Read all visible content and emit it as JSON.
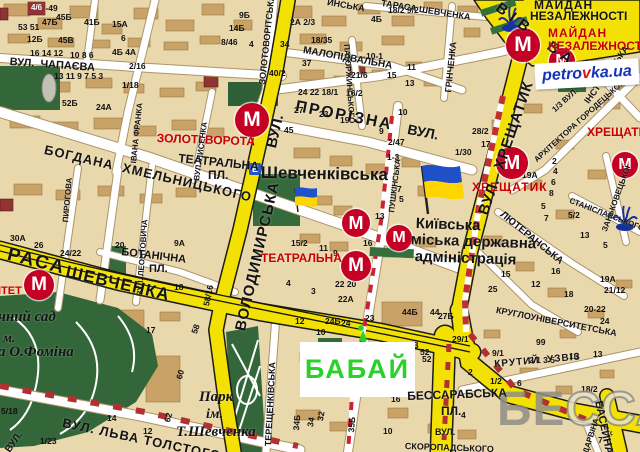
{
  "map": {
    "name": "kyiv-city-map"
  },
  "marker": {
    "label": "БАБАЙ",
    "color": "#2bd12b"
  },
  "watermark": {
    "part1": "БЕ",
    "part2": "ССА"
  },
  "logo": {
    "part1": "petro",
    "part2": "v",
    "part3": "ka.ua"
  },
  "signs": {
    "e": "Е"
  },
  "metro": {
    "symbol": "М",
    "color": "#c40024",
    "stations": [
      {
        "x": 252,
        "y": 120,
        "r": 17
      },
      {
        "x": 356,
        "y": 223,
        "r": 14
      },
      {
        "x": 399,
        "y": 238,
        "r": 13
      },
      {
        "x": 356,
        "y": 266,
        "r": 15
      },
      {
        "x": 39,
        "y": 285,
        "r": 15
      },
      {
        "x": 512,
        "y": 163,
        "r": 16
      },
      {
        "x": 625,
        "y": 165,
        "r": 13
      },
      {
        "x": 523,
        "y": 45,
        "r": 17
      },
      {
        "x": 562,
        "y": 61,
        "r": 13
      }
    ]
  },
  "badges": [
    {
      "t": "4/6",
      "x": 28,
      "y": 2
    }
  ],
  "labels": [
    {
      "n": "street-chapaieva",
      "t": "ВУЛ.  ЧАПАЄВА",
      "x": 10,
      "y": 57,
      "fs": 11,
      "rot": 4
    },
    {
      "n": "street-yaroslaviv-val",
      "t": "ВІВ  ВАЛ",
      "x": 502,
      "y": 0,
      "fs": 15,
      "rot": 37,
      "ls": 6
    },
    {
      "n": "street-irynynska-frag",
      "t": "ИНСЬКА",
      "x": 328,
      "y": -2,
      "fs": 9,
      "rot": 10
    },
    {
      "n": "street-prov-tarasa-shevchenka",
      "t": "ТАРАСА ШЕВЧЕНКА",
      "x": 382,
      "y": -1,
      "fs": 9,
      "rot": 9
    },
    {
      "n": "street-zolotovoritska",
      "t": "ЗОЛОТОВОРІТСЬКА",
      "x": 258,
      "y": 84,
      "fs": 9,
      "rot": -84
    },
    {
      "n": "street-malopidvalna",
      "t": "МАЛОПІДВАЛЬНА",
      "x": 304,
      "y": 46,
      "fs": 10,
      "rot": 10
    },
    {
      "n": "street-patorzhynskoho",
      "t": "ПАТОРЖИНСЬКОГО",
      "x": 350,
      "y": 44,
      "fs": 8,
      "rot": 86
    },
    {
      "n": "street-hrinchenka",
      "t": "ГРІНЧЕНКА",
      "x": 444,
      "y": 92,
      "fs": 9,
      "rot": -84
    },
    {
      "n": "label-maidan-line1",
      "t": "МАЙДАН",
      "x": 534,
      "y": -1,
      "fs": 12,
      "ls": 1
    },
    {
      "n": "label-maidan-line2",
      "t": "НЕЗАЛЕЖНОСТІ",
      "x": 530,
      "y": 10,
      "fs": 12
    },
    {
      "n": "metro-label-maidan-line1",
      "t": "МАЙДАН",
      "x": 548,
      "y": 27,
      "fs": 12,
      "c": "#c80000",
      "ls": 1
    },
    {
      "n": "metro-label-maidan-line2",
      "t": "НЕЗАЛЕЖНОСТІ",
      "x": 548,
      "y": 40,
      "fs": 12,
      "c": "#c80000"
    },
    {
      "n": "street-instytutska",
      "t": "ІНСТИТУТСЬКА",
      "x": 583,
      "y": 100,
      "fs": 9,
      "rot": -54
    },
    {
      "n": "street-horodetskoho-num",
      "t": "1/3 ВУЛ.",
      "x": 551,
      "y": 108,
      "fs": 8,
      "rot": -42
    },
    {
      "n": "street-horodetskoho",
      "t": "АРХІТЕКТОРА ГОРОДЕЦЬКОГО",
      "x": 533,
      "y": 158,
      "fs": 8,
      "rot": -42
    },
    {
      "n": "street-prorizna",
      "t": "ПРОРІЗНА",
      "x": 297,
      "y": 99,
      "fs": 16,
      "rot": 11,
      "ls": 2
    },
    {
      "n": "street-prorizna-vul",
      "t": "ВУЛ.",
      "x": 409,
      "y": 122,
      "fs": 14,
      "rot": 11
    },
    {
      "n": "metro-label-zoloti-vorota",
      "t": "ЗОЛОТІ ВОРОТА",
      "x": 157,
      "y": 132,
      "fs": 12,
      "c": "#c80000",
      "rot": 2
    },
    {
      "n": "label-teatralna-pl-line1",
      "t": "ТЕАТРАЛЬНА",
      "x": 179,
      "y": 152,
      "fs": 12,
      "rot": 6
    },
    {
      "n": "label-teatralna-pl-line2",
      "t": "ПЛ.",
      "x": 208,
      "y": 169,
      "fs": 12
    },
    {
      "n": "street-volodymyrska",
      "t": "ВОЛОДИМИРСЬКА",
      "x": 233,
      "y": 329,
      "fs": 15,
      "rot": -77,
      "ls": 1
    },
    {
      "n": "street-volodymyrska-vul",
      "t": "ВУЛ.",
      "x": 264,
      "y": 146,
      "fs": 15,
      "rot": -77
    },
    {
      "n": "label-shevchenkivska",
      "t": "Шевченківська",
      "x": 261,
      "y": 164,
      "fs": 17,
      "rot": 1
    },
    {
      "n": "street-lysenka",
      "t": "ВУЛ. ЛИСЕНКА",
      "x": 193,
      "y": 180,
      "fs": 8,
      "rot": -82
    },
    {
      "n": "street-ivana-franka",
      "t": "ІВАНА ФРАНКА",
      "x": 130,
      "y": 163,
      "fs": 8,
      "rot": -84
    },
    {
      "n": "street-khmelnytskoho",
      "t": "БОГДАНА  ХМЕЛЬНИЦЬКОГО",
      "x": 46,
      "y": 143,
      "fs": 13,
      "rot": 13,
      "ls": 1
    },
    {
      "n": "street-pyrohova",
      "t": "ПИРОГОВА",
      "x": 62,
      "y": 222,
      "fs": 8,
      "rot": -85
    },
    {
      "n": "street-leontovycha",
      "t": "ВУЛ. ЛЕОНТОВИЧА",
      "x": 136,
      "y": 296,
      "fs": 8,
      "rot": -86
    },
    {
      "n": "metro-label-teatralna",
      "t": "ТЕАТРАЛЬНА",
      "x": 261,
      "y": 252,
      "fs": 12,
      "c": "#c80000"
    },
    {
      "n": "label-kmda-line1",
      "t": "Київська",
      "x": 416,
      "y": 216,
      "fs": 15,
      "rot": 2
    },
    {
      "n": "label-kmda-line2",
      "t": "міська державна",
      "x": 411,
      "y": 232,
      "fs": 15,
      "rot": 2
    },
    {
      "n": "label-kmda-line3",
      "t": "адміністрація",
      "x": 415,
      "y": 249,
      "fs": 15,
      "rot": 2
    },
    {
      "n": "metro-label-khreshchatyk-1",
      "t": "ХРЕЩАТИК",
      "x": 472,
      "y": 181,
      "fs": 12,
      "c": "#c80000",
      "ls": 1
    },
    {
      "n": "metro-label-khreshchatyk-2",
      "t": "ХРЕЩАТИК",
      "x": 587,
      "y": 126,
      "fs": 12,
      "c": "#c80000"
    },
    {
      "n": "street-khreshchatyk",
      "t": "ВУЛ.  ХРЕЩАТИК",
      "x": 476,
      "y": 212,
      "fs": 15,
      "rot": -71,
      "ls": 1
    },
    {
      "n": "street-liuteranska",
      "t": "ЛЮТЕРАНСЬКА",
      "x": 504,
      "y": 210,
      "fs": 10,
      "rot": 39
    },
    {
      "n": "street-zankovetskoi",
      "t": "ЗАНЬКОВЕЦЬКОЇ",
      "x": 601,
      "y": 230,
      "fs": 8,
      "rot": -70
    },
    {
      "n": "street-stanislavskoho",
      "t": "СТАНІСЛАВСЬКОГО",
      "x": 571,
      "y": 197,
      "fs": 8,
      "rot": 21
    },
    {
      "n": "label-botanichna-line1",
      "t": "БОТАНІЧНА",
      "x": 122,
      "y": 247,
      "fs": 11,
      "rot": 7
    },
    {
      "n": "label-botanichna-line2",
      "t": "ПЛ.",
      "x": 149,
      "y": 264,
      "fs": 11
    },
    {
      "n": "street-taras-blvd-1",
      "t": "РАСА",
      "x": 10,
      "y": 245,
      "fs": 19,
      "rot": 14,
      "ls": 2
    },
    {
      "n": "street-taras-blvd-2",
      "t": "ШЕВЧЕНКА",
      "x": 68,
      "y": 263,
      "fs": 17,
      "rot": 13,
      "ls": 1
    },
    {
      "n": "metro-label-universytet-frag",
      "t": "ІТЕТ",
      "x": -2,
      "y": 286,
      "fs": 11,
      "c": "#c80000"
    },
    {
      "n": "label-botsad-line1",
      "t": "чний сад",
      "x": -2,
      "y": 310,
      "fs": 15,
      "f": 1
    },
    {
      "n": "label-botsad-line2",
      "t": "м.",
      "x": 3,
      "y": 331,
      "fs": 13,
      "f": 1
    },
    {
      "n": "label-botsad-line3",
      "t": "а О.Фоміна",
      "x": -2,
      "y": 345,
      "fs": 15,
      "f": 1
    },
    {
      "n": "street-tereshchenkivska",
      "t": "ТЕРЕЩЕНКІВСЬКА",
      "x": 264,
      "y": 446,
      "fs": 9,
      "rot": -87
    },
    {
      "n": "street-pushkinska",
      "t": "ПУШКІНСЬКА",
      "x": 388,
      "y": 212,
      "fs": 8,
      "rot": -83
    },
    {
      "n": "street-kruhlouniversytetska",
      "t": "КРУГЛОУНІВЕРСИТЕТСЬКА",
      "x": 497,
      "y": 306,
      "fs": 9,
      "rot": 11
    },
    {
      "n": "street-krutyi-uzviz",
      "t": "КРУТИЙ  УЗВІЗ",
      "x": 494,
      "y": 360,
      "fs": 10,
      "rot": -5,
      "ls": 1
    },
    {
      "n": "label-bessarabska-line1",
      "t": "БЕССАРАБСЬКА",
      "x": 407,
      "y": 390,
      "fs": 12,
      "rot": -2
    },
    {
      "n": "label-bessarabska-line2",
      "t": "ПЛ.",
      "x": 441,
      "y": 405,
      "fs": 12
    },
    {
      "n": "street-baseina",
      "t": "БАСЕЙНА",
      "x": 603,
      "y": 400,
      "fs": 11,
      "rot": 78
    },
    {
      "n": "street-skoropadskoho-1",
      "t": "ВУЛ.",
      "x": 435,
      "y": 428,
      "fs": 9
    },
    {
      "n": "street-skoropadskoho-2",
      "t": "СКОРОПАДСЬКОГО",
      "x": 405,
      "y": 442,
      "fs": 9,
      "rot": 2
    },
    {
      "n": "street-darvina",
      "t": "ДАРВІНА",
      "x": 582,
      "y": 452,
      "fs": 8,
      "rot": -72
    },
    {
      "n": "street-lva-tolstoho",
      "t": "ВУЛ. ЛЬВА ТОЛСТОГО",
      "x": 64,
      "y": 416,
      "fs": 13,
      "rot": 12,
      "ls": 1
    },
    {
      "n": "label-park-shevchenka-line1",
      "t": "Парк",
      "x": 199,
      "y": 390,
      "fs": 15,
      "f": 1
    },
    {
      "n": "label-park-shevchenka-line2",
      "t": "ім.",
      "x": 206,
      "y": 408,
      "fs": 14,
      "f": 1
    },
    {
      "n": "label-park-shevchenka-line3",
      "t": "Т.Шевченка",
      "x": 176,
      "y": 425,
      "fs": 15,
      "f": 1
    },
    {
      "n": "street-vul-frag",
      "t": "ВУЛ.",
      "x": 4,
      "y": 449,
      "fs": 10,
      "rot": -55
    }
  ],
  "numbers": [
    [
      "47-49",
      36,
      4
    ],
    [
      "53 51",
      18,
      23
    ],
    [
      "47Б",
      42,
      18
    ],
    [
      "45Б",
      56,
      13
    ],
    [
      "41Б",
      84,
      18
    ],
    [
      "15А",
      112,
      20
    ],
    [
      "12Б",
      27,
      35
    ],
    [
      "45В",
      58,
      36
    ],
    [
      "6",
      121,
      34
    ],
    [
      "16 14 12",
      30,
      49
    ],
    [
      "10 8 6",
      70,
      51
    ],
    [
      "4Б 4А",
      112,
      48
    ],
    [
      "2/16",
      129,
      62
    ],
    [
      "13 11 9 7 5 3",
      54,
      72
    ],
    [
      "1/18",
      122,
      81
    ],
    [
      "52Б",
      62,
      99
    ],
    [
      "24А",
      96,
      103
    ],
    [
      "9Б",
      239,
      11
    ],
    [
      "14Б",
      229,
      24
    ],
    [
      "8/46",
      221,
      38
    ],
    [
      "4",
      249,
      40
    ],
    [
      "2А 2/3",
      290,
      18
    ],
    [
      "34",
      280,
      40
    ],
    [
      "40/2",
      269,
      69
    ],
    [
      "18/35",
      311,
      36
    ],
    [
      "37",
      302,
      59
    ],
    [
      "24 22 18/1",
      298,
      88
    ],
    [
      "10-1",
      366,
      52
    ],
    [
      "21/6",
      351,
      71
    ],
    [
      "16/2",
      346,
      89
    ],
    [
      "15",
      387,
      71
    ],
    [
      "11",
      407,
      63
    ],
    [
      "13",
      405,
      79
    ],
    [
      "18/2 9/2",
      388,
      6
    ],
    [
      "4Б",
      371,
      15
    ],
    [
      "27",
      294,
      106
    ],
    [
      "23",
      319,
      110
    ],
    [
      "19",
      340,
      116
    ],
    [
      "45",
      284,
      126
    ],
    [
      "9",
      379,
      127
    ],
    [
      "10",
      398,
      108
    ],
    [
      "2/47",
      388,
      138
    ],
    [
      "1-3",
      387,
      153
    ],
    [
      "1/30",
      455,
      148
    ],
    [
      "7",
      397,
      185
    ],
    [
      "5",
      399,
      195
    ],
    [
      "13",
      375,
      212
    ],
    [
      "15/2",
      291,
      239
    ],
    [
      "11",
      319,
      244
    ],
    [
      "9",
      333,
      249
    ],
    [
      "16",
      363,
      239
    ],
    [
      "4",
      286,
      279
    ],
    [
      "3",
      311,
      287
    ],
    [
      "22 20",
      335,
      280
    ],
    [
      "22А",
      338,
      295
    ],
    [
      "24Б",
      325,
      317
    ],
    [
      "24",
      341,
      319
    ],
    [
      "12",
      295,
      317
    ],
    [
      "10",
      316,
      328
    ],
    [
      "23",
      365,
      314
    ],
    [
      "44Б",
      402,
      308
    ],
    [
      "44",
      430,
      308
    ],
    [
      "50В",
      403,
      341
    ],
    [
      "52",
      422,
      355
    ],
    [
      "28/2",
      472,
      127
    ],
    [
      "17",
      481,
      140
    ],
    [
      "19А",
      522,
      171
    ],
    [
      "2",
      552,
      157
    ],
    [
      "4",
      553,
      167
    ],
    [
      "6",
      551,
      178
    ],
    [
      "8",
      549,
      189
    ],
    [
      "5",
      541,
      202
    ],
    [
      "7",
      544,
      214
    ],
    [
      "5/2",
      568,
      211
    ],
    [
      "13",
      580,
      231
    ],
    [
      "5",
      603,
      241
    ],
    [
      "16",
      551,
      267
    ],
    [
      "18",
      564,
      290
    ],
    [
      "20-22",
      584,
      305
    ],
    [
      "24",
      600,
      317
    ],
    [
      "19А",
      600,
      275
    ],
    [
      "21/12",
      604,
      286
    ],
    [
      "29/1",
      452,
      335
    ],
    [
      "27Б",
      438,
      312
    ],
    [
      "25",
      488,
      285
    ],
    [
      "15",
      501,
      270
    ],
    [
      "12",
      531,
      280
    ],
    [
      "9/1",
      492,
      349
    ],
    [
      "99",
      536,
      338
    ],
    [
      "2/1 3 5",
      529,
      356
    ],
    [
      "16",
      569,
      352
    ],
    [
      "13",
      593,
      350
    ],
    [
      "18/2",
      581,
      385
    ],
    [
      "1/2",
      490,
      377
    ],
    [
      "6",
      517,
      379
    ],
    [
      "2",
      468,
      368
    ],
    [
      "52",
      420,
      348
    ],
    [
      "4",
      461,
      411
    ],
    [
      "7",
      598,
      436
    ],
    [
      "30А",
      10,
      234
    ],
    [
      "26",
      34,
      241
    ],
    [
      "24/22",
      60,
      249
    ],
    [
      "20",
      115,
      241
    ],
    [
      "9А",
      174,
      239
    ],
    [
      "18",
      174,
      283
    ],
    [
      "17",
      146,
      326
    ],
    [
      "58",
      190,
      332,
      -70
    ],
    [
      "60",
      175,
      378,
      -75
    ],
    [
      "62",
      163,
      421,
      -75
    ],
    [
      "14",
      107,
      414
    ],
    [
      "12",
      143,
      427
    ],
    [
      "5/18",
      1,
      407
    ],
    [
      "1/23",
      40,
      437
    ],
    [
      "34Б",
      292,
      430,
      -85
    ],
    [
      "34",
      306,
      426,
      -80
    ],
    [
      "32",
      316,
      420,
      -80
    ],
    [
      "35Б",
      347,
      432,
      -85
    ],
    [
      "16",
      391,
      395
    ],
    [
      "10",
      383,
      427
    ],
    [
      "58/16",
      202,
      305,
      -78
    ]
  ]
}
